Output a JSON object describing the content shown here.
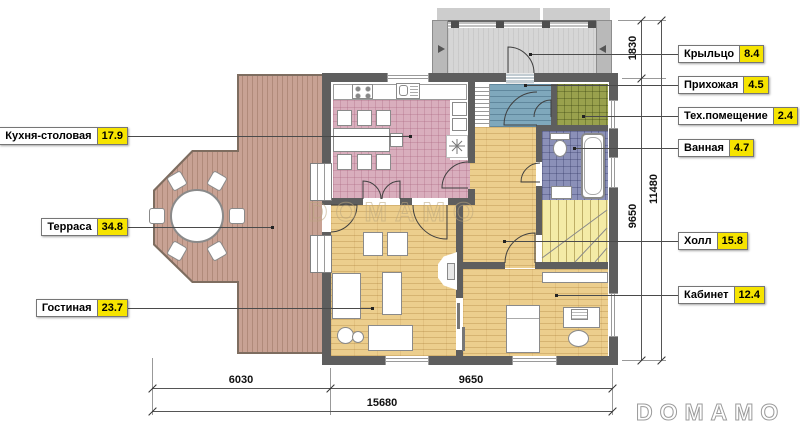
{
  "title": "Floor plan with room areas (Russian)",
  "labels": {
    "left": [
      {
        "name": "Кухня-столовая",
        "value": "17.9"
      },
      {
        "name": "Терраса",
        "value": "34.8"
      },
      {
        "name": "Гостиная",
        "value": "23.7"
      }
    ],
    "right": [
      {
        "name": "Крыльцо",
        "value": "8.4"
      },
      {
        "name": "Прихожая",
        "value": "4.5"
      },
      {
        "name": "Тех.помещение",
        "value": "2.4"
      },
      {
        "name": "Ванная",
        "value": "4.7"
      },
      {
        "name": "Холл",
        "value": "15.8"
      },
      {
        "name": "Кабинет",
        "value": "12.4"
      }
    ]
  },
  "dimensions": {
    "right_vertical": [
      "1830",
      "9650",
      "11480"
    ],
    "bottom": [
      "6030",
      "9650",
      "15680"
    ]
  },
  "watermark_text": "DOMAMO",
  "brand_logo": "DOMAMO",
  "colors": {
    "label_value_highlight": "#f6e400",
    "wall": "#5e5e5e",
    "kitchen_tile": "#d9aebd",
    "wood_floor": "#ecce8d",
    "terrace_deck": "#c8a294",
    "entry_floor": "#7fa8bc",
    "tech_room": "#99a14d",
    "bathroom_tile": "#8b90b8",
    "porch_floor": "#d6d6d6",
    "stairs": "#f4eba6"
  }
}
